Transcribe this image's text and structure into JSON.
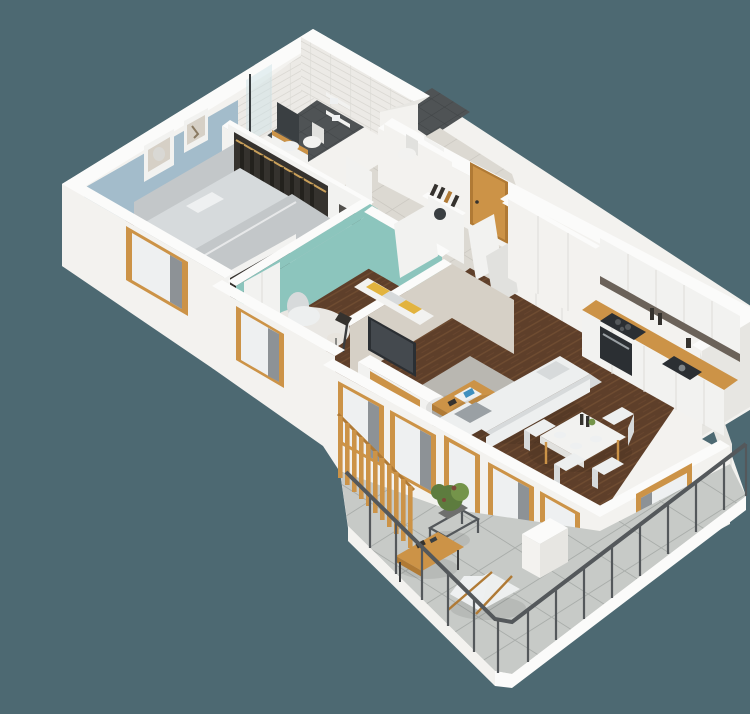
{
  "scene": {
    "type": "isometric-3d-floor-plan-render",
    "subject": "3D cutaway floor plan of a two-bedroom apartment with wrap-around balcony",
    "view": "isometric bird's-eye",
    "background": "#4d6972"
  },
  "palette": {
    "bg": "#4d6972",
    "wallTop": "#fbfbfa",
    "wallFace": "#f3f2ef",
    "wallShade": "#e7e6e2",
    "wallDark": "#d9d8d4",
    "brick": "#eceae6",
    "brickLine": "#dbd9d4",
    "blueWall": "#a3bccb",
    "tealWall": "#8cc5bd",
    "greige": "#d6d0c6",
    "floorWood": "#5e3f2a",
    "floorWoodLight": "#6f4c31",
    "tileHall": "#dcd9d2",
    "tileHallLine": "#c8c5be",
    "tileBath": "#4f5355",
    "tileBathLine": "#414547",
    "tileBalcony": "#c7cac7",
    "tileBalconyLine": "#a9adaa",
    "wood": "#cc9347",
    "woodDark": "#b07a35",
    "white": "#f2f2f0",
    "whiteShade": "#e1e1de",
    "sofa": "#edefef",
    "sofaShade": "#d7dadb",
    "bedGray": "#c3c7c9",
    "bedLight": "#d6dadc",
    "dark": "#35322e",
    "tv": "#2b2f33",
    "green": "#5d7c3e",
    "greenLight": "#74944a",
    "yellow": "#e2b33e",
    "curtain": "#eef0f1",
    "mirror": "#3a3f42",
    "railing": "#54585b"
  },
  "rooms": [
    {
      "name": "bedroom",
      "walls": "white with blue accent wall and two framed pictures",
      "floor": "walnut plank",
      "furniture": [
        "double bed with gray bedding and pillows",
        "open wardrobe with hanging clothes",
        "second open wardrobe",
        "window with wood frame"
      ]
    },
    {
      "name": "bathroom",
      "walls": "white subway tile",
      "floor": "dark gray tile",
      "furniture": [
        "walk-in shower",
        "vanity with mirror",
        "toilet",
        "towel shelves"
      ]
    },
    {
      "name": "wc",
      "walls": "white subway tile",
      "floor": "dark gray tile",
      "furniture": [
        "toilet",
        "shelves"
      ]
    },
    {
      "name": "entry-hall",
      "walls": "white",
      "floor": "beige large-format tile",
      "furniture": [
        "wood entry door",
        "built-in white closets",
        "shoe cabinet with items",
        "washing machine"
      ]
    },
    {
      "name": "study",
      "walls": "teal",
      "floor": "walnut plank",
      "furniture": [
        "white round rug",
        "white armchair",
        "side table and floor lamp",
        "bench with yellow and gray cushions",
        "white wardrobe",
        "plant"
      ]
    },
    {
      "name": "living-room",
      "walls": "white and greige",
      "floor": "walnut plank",
      "furniture": [
        "wall TV on white media unit",
        "gray rug",
        "wood coffee table with magazines",
        "white corner sofa",
        "potted plant"
      ]
    },
    {
      "name": "dining-area",
      "walls": "white with windows",
      "floor": "walnut plank",
      "furniture": [
        "white dining table with plates and bottles",
        "four white chairs"
      ]
    },
    {
      "name": "kitchen",
      "walls": "white",
      "floor": "walnut plank",
      "furniture": [
        "tall white cabinet columns",
        "white wall cabinets",
        "oak countertop",
        "black cooktop and oven",
        "black sink"
      ]
    },
    {
      "name": "balcony",
      "walls": "white parapet with metal railing",
      "floor": "gray concrete tile",
      "furniture": [
        "wood slat privacy screen",
        "potted plant on wire stand",
        "wood coffee table",
        "white butterfly chair",
        "white planter box"
      ]
    }
  ]
}
